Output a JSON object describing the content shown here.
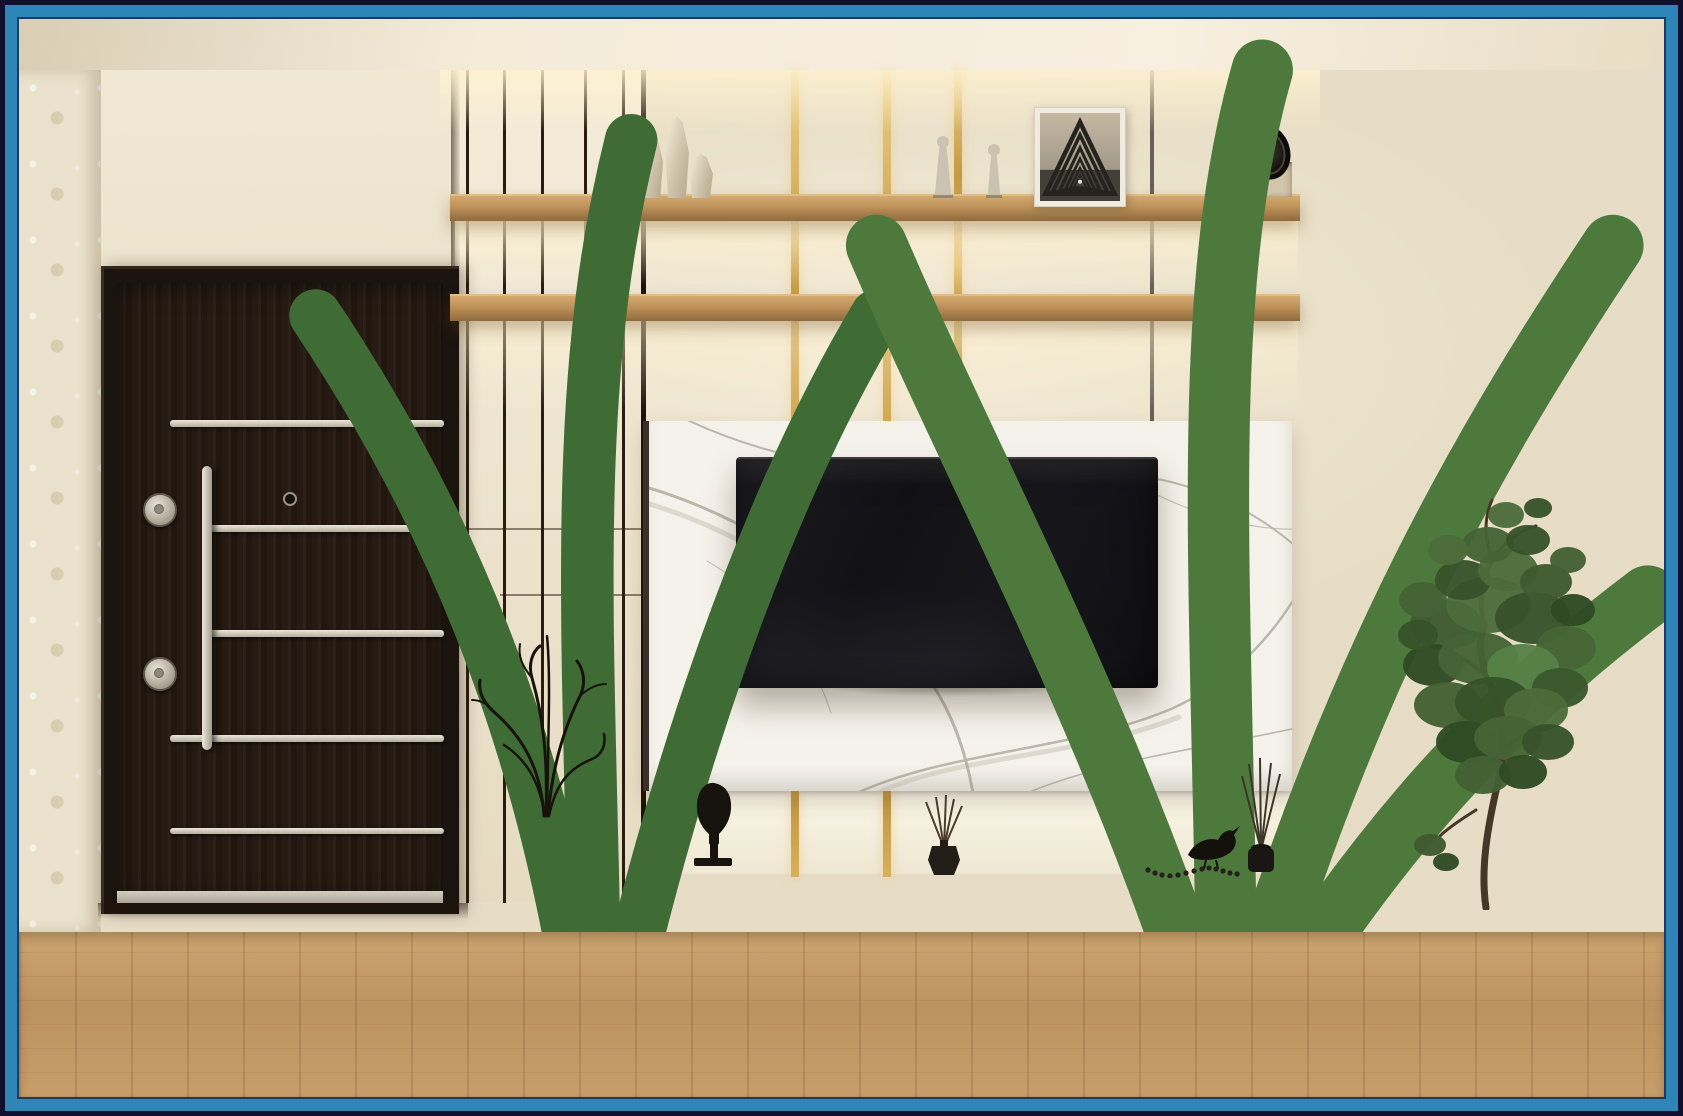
{
  "scene": {
    "description": "3D interior render of a modern living-room TV wall unit with a dark entry door, wooden shelves, marble TV panel and decor",
    "watermark": "hamrahcabinet",
    "shelf_letter_tile": "S"
  },
  "brand": {
    "monogram": "hc",
    "name_line1": "HAMRAH",
    "name_line2": "CABINET.IR"
  },
  "colors": {
    "brand_blue": "#2e86b8",
    "frame_navy": "#10102e",
    "gold_inlay": "#cfa64a",
    "shelf_wood": "#b9905c",
    "floor_wood": "#c49a66",
    "door_wood": "#261b13",
    "marble_white": "#f5f2eb",
    "wall_cream": "#e9e0ca",
    "cabinet_white": "#eee8da",
    "tv_black": "#141417",
    "vase_red": "#9e3c1d",
    "art_olive": "#59603e",
    "art_peach": "#e9bd8d",
    "plant_green": "#4d6b3c",
    "metal_silver": "#d2ccbf"
  },
  "objects": [
    {
      "name": "entry-door",
      "label": "dark wood security door with vertical steel handle, two lock cylinders and steel strips"
    },
    {
      "name": "wall-shelves",
      "label": "two full-width wooden display shelves with warm under-shelf lighting"
    },
    {
      "name": "marble-tv-panel",
      "label": "white marble TV back panel with gray veining"
    },
    {
      "name": "television",
      "label": "wall-mounted black flat-screen TV"
    },
    {
      "name": "media-cabinet",
      "label": "white floating media cabinet with four drawers on a wooden plinth"
    },
    {
      "name": "gold-inlay-strips",
      "label": "vertical brass inlay strips on the feature wall"
    },
    {
      "name": "intercom-unit",
      "label": "white video intercom panel"
    },
    {
      "name": "light-switches",
      "label": "row of four wall switches"
    },
    {
      "name": "decor-vases",
      "label": "three faceted cream vases on top shelf"
    },
    {
      "name": "figurines",
      "label": "two small stone figurines"
    },
    {
      "name": "triangle-photo",
      "label": "white-framed photo of nested dark triangles"
    },
    {
      "name": "clock-sculpture",
      "label": "black decorative clock in a wall niche"
    },
    {
      "name": "botanical-frame",
      "label": "small framed botanical print"
    },
    {
      "name": "letter-tile",
      "label": "small tile with the letter S"
    },
    {
      "name": "potted-grasses",
      "label": "two small potted green plants on lower shelf"
    },
    {
      "name": "ceramic-set",
      "label": "white bowl, white vase and brown lidded jar"
    },
    {
      "name": "head-bust",
      "label": "black head sculpture on a stand"
    },
    {
      "name": "book-stack",
      "label": "stack of coffee-table books"
    },
    {
      "name": "reed-diffusers",
      "label": "two black reed diffusers"
    },
    {
      "name": "bird-figurine",
      "label": "black bird figurine with bead chain"
    },
    {
      "name": "red-floor-vase",
      "label": "tall red fluted vase with dry black branches"
    },
    {
      "name": "abstract-art",
      "label": "black-framed abstract art with olive, beige and peach shapes"
    },
    {
      "name": "potted-tree",
      "label": "green indoor tree in a white faceted planter"
    },
    {
      "name": "area-rug",
      "label": "light patterned rug on the wood floor"
    }
  ]
}
